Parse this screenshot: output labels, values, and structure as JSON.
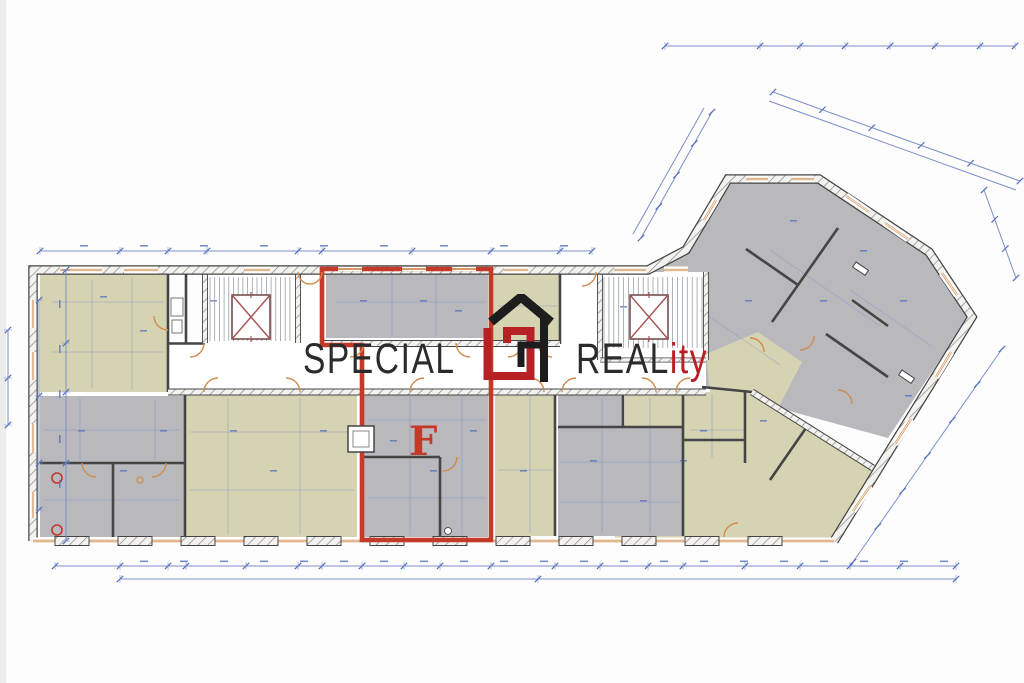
{
  "watermark": {
    "word_left": "SPECIAL",
    "word_right": "REAL",
    "word_right_accent": "ity"
  },
  "plan": {
    "unit_label": "F"
  },
  "colors": {
    "room_beige": "#d6d3b3",
    "room_gray": "#b8b8bd",
    "wall_dark": "#454545",
    "wall_hatch_bg": "#f3f2ee",
    "wall_hatch_line": "#8f8f8f",
    "dim_blue": "#7b8fc9",
    "dim_blue_strong": "#5570bd",
    "accent_orange": "#cf8c4e",
    "unit_red": "#c43a28",
    "elevator_red": "#a85252",
    "stair_gray": "#9aa0a8",
    "logo_black": "#1d1d1d",
    "logo_red": "#b72025",
    "watermark_text": "#2b2b2b"
  }
}
